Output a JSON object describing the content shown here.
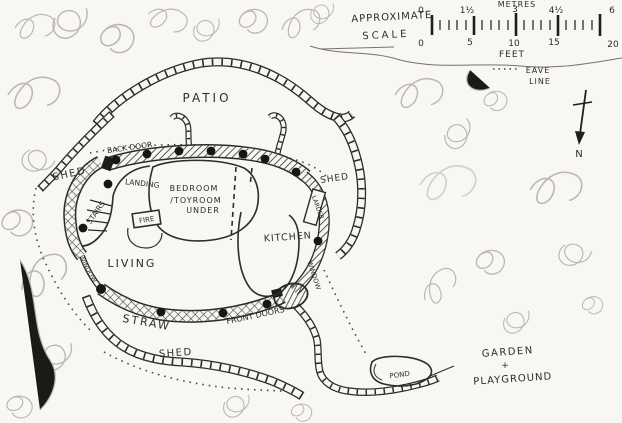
{
  "scale_bar": {
    "title_line1": "APPROXIMATE",
    "title_line2": "SCALE",
    "top_unit": "METRES",
    "top_ticks": [
      "0",
      "1½",
      "3",
      "4½",
      "6"
    ],
    "bottom_ticks": [
      "0",
      "5",
      "10",
      "15",
      "20"
    ],
    "bottom_unit": "FEET"
  },
  "legend": {
    "eave_line_1": "EAVE",
    "eave_line_2": "LINE",
    "north_label": "N"
  },
  "plan_labels": {
    "patio": "PATIO",
    "back_door": "BACK DOOR",
    "shed_left": "SHED",
    "shed_right": "SHED",
    "shed_bottom": "SHED",
    "landing": "LANDING",
    "bedroom_line1": "BEDROOM",
    "bedroom_line2": "/TOYROOM",
    "bedroom_line3": "UNDER",
    "stairs": "STAIRS",
    "fire": "FIRE",
    "kitchen": "KITCHEN",
    "larder": "LARDER",
    "living": "LIVING",
    "window_left": "WINDOW",
    "window_right": "WINDOW",
    "straw": "STRAW",
    "front_doors": "FRONT DOORS",
    "pond": "POND",
    "garden_line1": "GARDEN",
    "garden_line2": "+",
    "garden_line3": "PLAYGROUND"
  },
  "colors": {
    "ink": "#2b2b2b",
    "pencil": "#b3b0aa",
    "paper": "#f8f7f4"
  }
}
